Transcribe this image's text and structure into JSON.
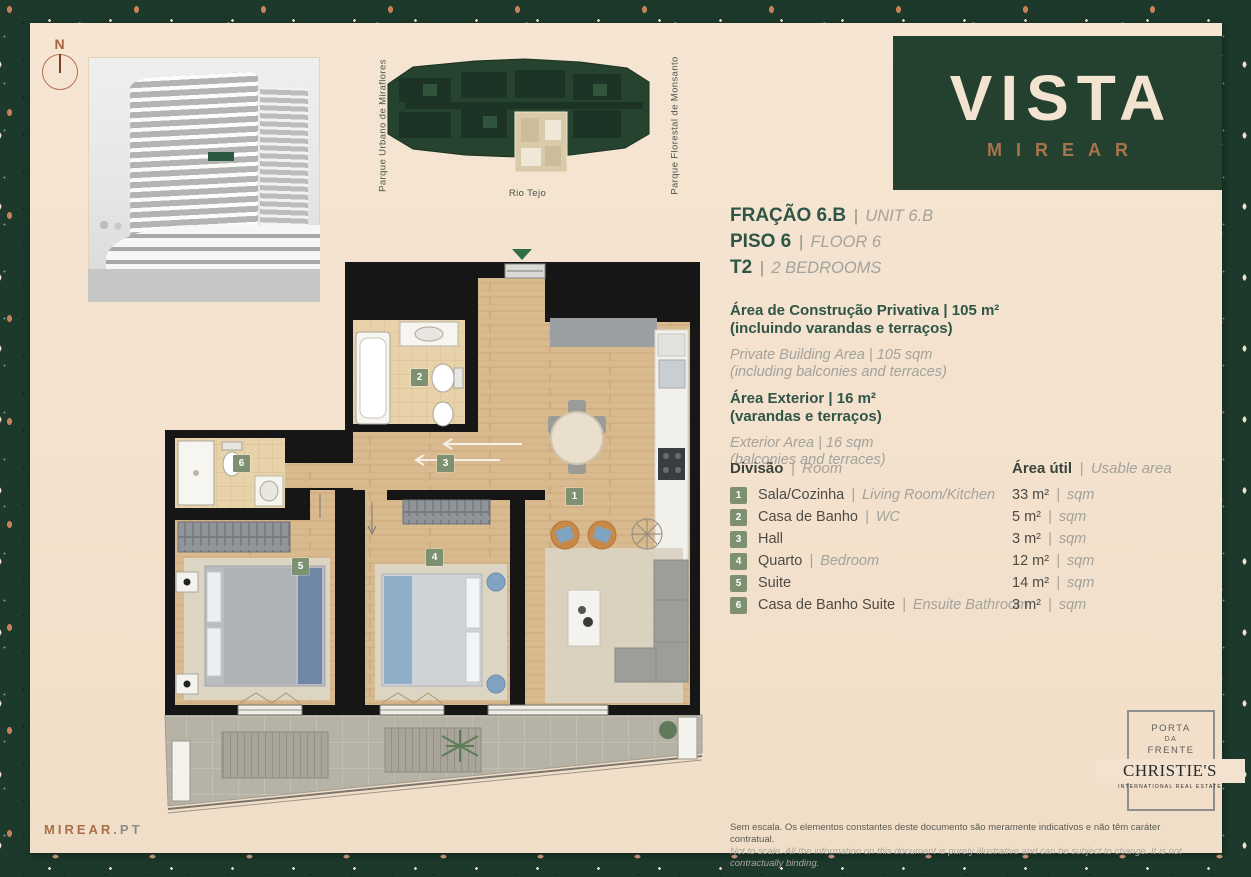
{
  "sep": "|",
  "compass": {
    "label": "N"
  },
  "keyplan": {
    "label_left": "Parque Urbano de Miraflores",
    "label_right": "Parque Florestal de Monsanto",
    "label_bottom": "Rio Tejo"
  },
  "brand": {
    "name": "VISTA",
    "sub": "MIREAR"
  },
  "unit": {
    "fraction_pt": "FRAÇÃO 6.B",
    "fraction_en": "UNIT 6.B",
    "floor_pt": "PISO 6",
    "floor_en": "FLOOR 6",
    "type_pt": "T2",
    "type_en": "2 BEDROOMS"
  },
  "areas": {
    "private_pt1": "Área de Construção Privativa | 105 m²",
    "private_pt2": "(incluindo varandas e terraços)",
    "private_en1": "Private Building Area | 105 sqm",
    "private_en2": "(including balconies and terraces)",
    "exterior_pt1": "Área Exterior | 16 m²",
    "exterior_pt2": "(varandas e terraços)",
    "exterior_en1": "Exterior Area | 16 sqm",
    "exterior_en2": "(balconies and terraces)"
  },
  "room_table": {
    "header_pt": "Divisão",
    "header_en": "Room",
    "header_area_pt": "Área útil",
    "header_area_en": "Usable area",
    "rows": [
      {
        "num": "1",
        "name_pt": "Sala/Cozinha",
        "name_en": "Living Room/Kitchen",
        "area": "33 m²",
        "area_en": "sqm"
      },
      {
        "num": "2",
        "name_pt": "Casa de Banho",
        "name_en": "WC",
        "area": "5 m²",
        "area_en": "sqm"
      },
      {
        "num": "3",
        "name_pt": "Hall",
        "name_en": "",
        "area": "3 m²",
        "area_en": "sqm"
      },
      {
        "num": "4",
        "name_pt": "Quarto",
        "name_en": "Bedroom",
        "area": "12 m²",
        "area_en": "sqm"
      },
      {
        "num": "5",
        "name_pt": "Suite",
        "name_en": "",
        "area": "14 m²",
        "area_en": "sqm"
      },
      {
        "num": "6",
        "name_pt": "Casa de Banho Suite",
        "name_en": "Ensuite Bathroom",
        "area": "3 m²",
        "area_en": "sqm"
      }
    ]
  },
  "floorplan": {
    "badges": [
      "1",
      "2",
      "3",
      "4",
      "5",
      "6"
    ]
  },
  "footer": {
    "site_brand": "MIREAR",
    "site_tld": ".PT",
    "disclaimer_pt": "Sem escala. Os elementos constantes deste documento são meramente indicativos e não têm caráter contratual.",
    "disclaimer_en": "Not to scale. All the information on this document is purely illustrative and can be subject to change. It is not contractually binding.",
    "agency": {
      "line1": "PORTA",
      "line2": "DA",
      "line3": "FRENTE",
      "name": "CHRISTIE'S",
      "sub": "INTERNATIONAL REAL ESTATE"
    }
  },
  "colors": {
    "terrazzo_green": "#1d392c",
    "cream": "#f3e1cd",
    "brand_green": "#2f5547",
    "copper": "#a8744d",
    "badge_green": "#7d9170"
  }
}
